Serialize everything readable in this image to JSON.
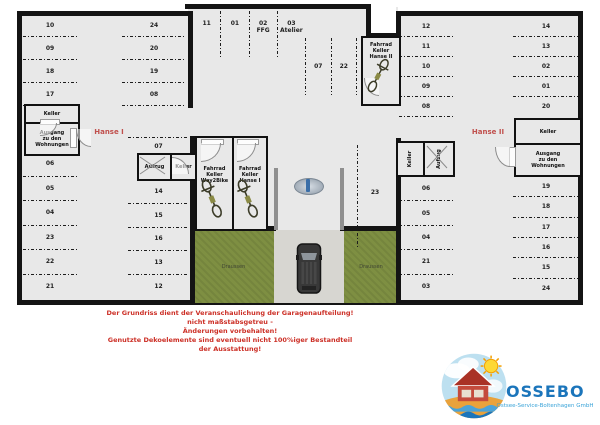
{
  "colors": {
    "floor": "#e8e8e8",
    "wall": "#141414",
    "accent": "#c0504d",
    "warnred": "#cc2f26",
    "green": "#7e8f42",
    "drive": "#d7d6d1",
    "logoblue": "#1b75bb",
    "logolightblue": "#39a3d8"
  },
  "plan": {
    "hanse1": {
      "label": "Hanse I",
      "top_slots": [
        "11",
        "01",
        "02\nFFG",
        "03\nAtelier"
      ],
      "colA": [
        "10",
        "09",
        "18",
        "17"
      ],
      "colB": [
        "24",
        "20",
        "19",
        "08"
      ],
      "colC": [
        "06",
        "05",
        "04",
        "23",
        "22",
        "21"
      ],
      "colD": [
        "14",
        "15",
        "16",
        "13",
        "12"
      ],
      "slot07": "07",
      "rooms": {
        "keller": "Keller",
        "ausgang": "Ausgang\nzu den\nWohnungen",
        "aufzug": "Aufzug",
        "keller2": "Keller",
        "bike_way2bike": "Fahrrad\nKeller\nWay2Bike",
        "bike_hanse1": "Fahrrad\nKeller\nHanse I"
      }
    },
    "hanse2": {
      "label": "Hanse II",
      "top_slots": [
        "07",
        "22"
      ],
      "slot23": "23",
      "colE": [
        "12",
        "11",
        "10",
        "09",
        "08"
      ],
      "colF": [
        "14",
        "13",
        "02",
        "01",
        "20"
      ],
      "colG": [
        "06",
        "05",
        "04",
        "21",
        "03"
      ],
      "colH": [
        "19",
        "18",
        "17",
        "16",
        "15",
        "24"
      ],
      "rooms": {
        "bike_hanse2": "Fahrrad\nKeller\nHanse II",
        "keller_left": "Keller",
        "aufzug": "Aufzug",
        "keller_right": "Keller",
        "ausgang": "Ausgang\nzu den\nWohnungen"
      }
    },
    "outside": {
      "left": "Draussen",
      "right": "Draussen"
    }
  },
  "disclaimer": {
    "lines": [
      "Der Grundriss dient der Veranschaulichung der Garagenaufteilung!",
      "nicht maßstabsgetreu -",
      "Änderungen vorbehalten!",
      "Genutzte Dekoelemente sind eventuell nicht 100%iger Bestandteil",
      "der Ausstattung!"
    ]
  },
  "logo": {
    "name": "OSSEBO",
    "subtitle": "Ostsee-Service-Boltenhagen GmbH"
  }
}
